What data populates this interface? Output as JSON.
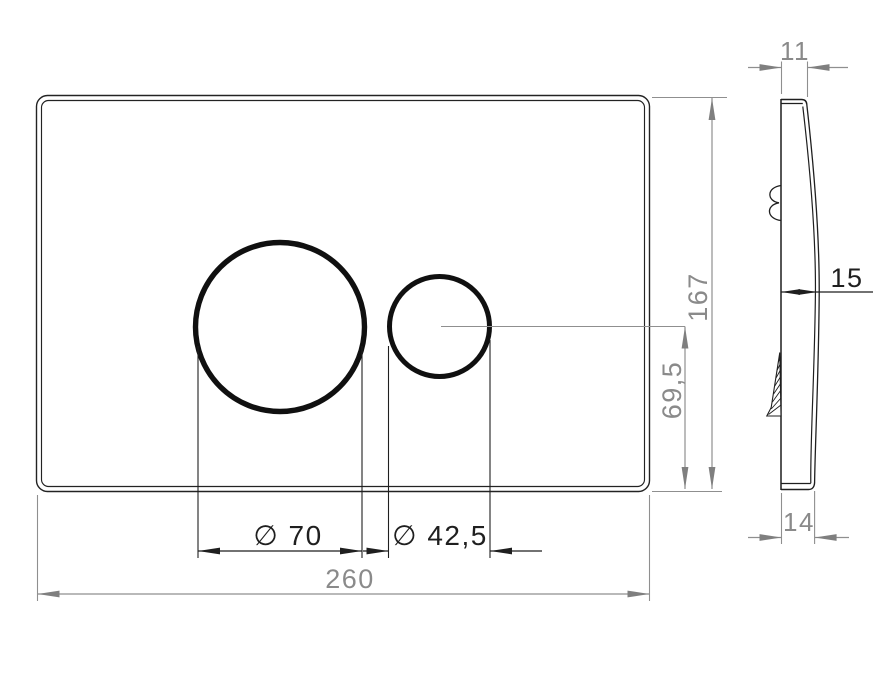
{
  "front_view": {
    "overall_width": "260",
    "overall_height": "167",
    "large_button_diameter": "∅ 70",
    "small_button_diameter": "∅ 42,5",
    "button_center_height": "69,5"
  },
  "side_view": {
    "top_depth": "11",
    "mid_depth": "15",
    "bottom_depth": "14"
  },
  "colors": {
    "outline_black": "#1f1f1f",
    "dimension_gray": "#8f8f8f",
    "background": "#ffffff"
  }
}
